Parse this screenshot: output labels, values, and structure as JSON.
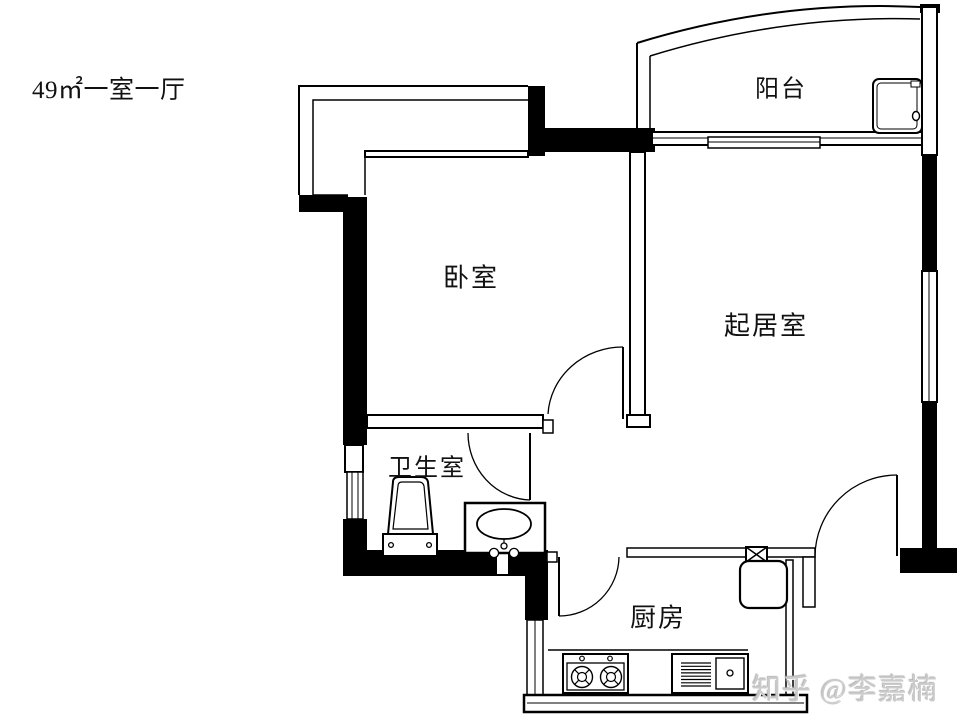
{
  "title": "49㎡一室一厅",
  "rooms": {
    "balcony": "阳台",
    "bedroom": "卧室",
    "living_room": "起居室",
    "bathroom": "卫生室",
    "kitchen": "厨房"
  },
  "watermark": "知乎 @李嘉楠",
  "colors": {
    "wall": "#000000",
    "background": "#ffffff",
    "watermark_gray": "#cbcbcb"
  },
  "fixtures": [
    "toilet-icon",
    "bathroom-sink-icon",
    "washing-machine-icon",
    "gas-stove-icon",
    "kitchen-sink-icon",
    "refrigerator-icon",
    "flue-icon"
  ]
}
